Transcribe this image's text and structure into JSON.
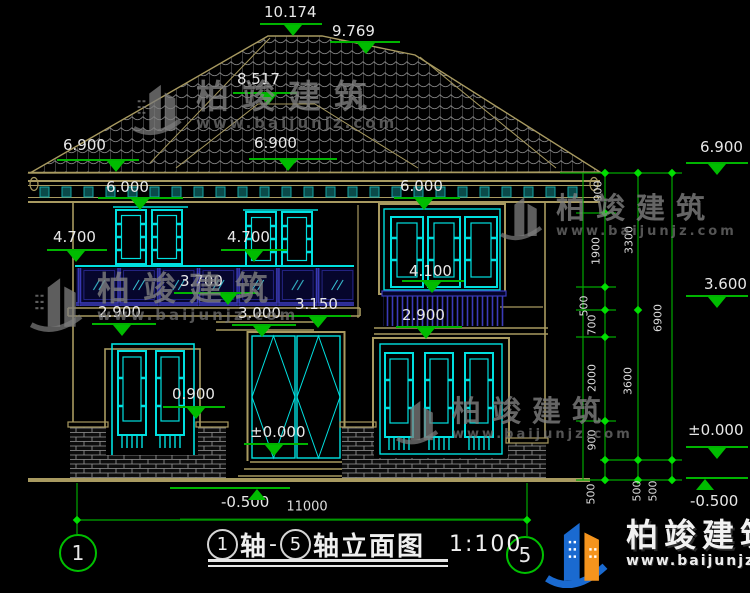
{
  "watermark": {
    "brand": "柏竣建筑",
    "url": "www.baijunjz.com"
  },
  "title_block": {
    "axis_from": "1",
    "zhou": "轴",
    "dash": "-",
    "axis_to": "5",
    "suffix": "轴立面图",
    "scale": "1:100"
  },
  "axis_bubbles": {
    "left": "1",
    "right": "5"
  },
  "colors": {
    "dim_green": "#00b400",
    "cad_cyan": "#00e0e0",
    "cad_tan": "#a89a60",
    "rail_blue": "#3a3ab8",
    "text_white": "#e8e8e8",
    "brand_blue": "#1a6ad0",
    "brand_orange": "#f5941d"
  },
  "elevation_markers": [
    {
      "text": "10.174",
      "tx": 264,
      "ty": 4,
      "lx": 260,
      "lw": 62,
      "ly": 23,
      "ax": 293,
      "dir": "down"
    },
    {
      "text": "9.769",
      "tx": 332,
      "ty": 23,
      "lx": 330,
      "lw": 70,
      "ly": 41,
      "ax": 366,
      "dir": "down"
    },
    {
      "text": "8.517",
      "tx": 237,
      "ty": 71,
      "lx": 233,
      "lw": 64,
      "ly": 92,
      "ax": 268,
      "dir": "down"
    },
    {
      "text": "6.900",
      "tx": 63,
      "ty": 137,
      "lx": 57,
      "lw": 82,
      "ly": 159,
      "ax": 116,
      "dir": "down"
    },
    {
      "text": "6.900",
      "tx": 254,
      "ty": 135,
      "lx": 249,
      "lw": 88,
      "ly": 158,
      "ax": 288,
      "dir": "down"
    },
    {
      "text": "6.900",
      "tx": 700,
      "ty": 139,
      "lx": 686,
      "lw": 62,
      "ly": 162,
      "ax": 717,
      "dir": "down"
    },
    {
      "text": "6.000",
      "tx": 106,
      "ty": 179,
      "lx": 98,
      "lw": 85,
      "ly": 197,
      "ax": 140,
      "dir": "down"
    },
    {
      "text": "6.000",
      "tx": 400,
      "ty": 178,
      "lx": 394,
      "lw": 66,
      "ly": 197,
      "ax": 424,
      "dir": "down"
    },
    {
      "text": "4.700",
      "tx": 53,
      "ty": 229,
      "lx": 47,
      "lw": 60,
      "ly": 249,
      "ax": 76,
      "dir": "down"
    },
    {
      "text": "4.700",
      "tx": 227,
      "ty": 229,
      "lx": 221,
      "lw": 66,
      "ly": 249,
      "ax": 254,
      "dir": "down"
    },
    {
      "text": "3.700",
      "tx": 180,
      "ty": 273,
      "lx": 174,
      "lw": 84,
      "ly": 292,
      "ax": 228,
      "dir": "down"
    },
    {
      "text": "4.100",
      "tx": 409,
      "ty": 263,
      "lx": 402,
      "lw": 62,
      "ly": 280,
      "ax": 432,
      "dir": "down"
    },
    {
      "text": "2.900",
      "tx": 98,
      "ty": 304,
      "lx": 92,
      "lw": 64,
      "ly": 323,
      "ax": 122,
      "dir": "down"
    },
    {
      "text": "3.000",
      "tx": 238,
      "ty": 305,
      "lx": 232,
      "lw": 64,
      "ly": 324,
      "ax": 262,
      "dir": "down"
    },
    {
      "text": "3.150",
      "tx": 295,
      "ty": 296,
      "lx": 289,
      "lw": 62,
      "ly": 315,
      "ax": 318,
      "dir": "down"
    },
    {
      "text": "2.900",
      "tx": 402,
      "ty": 307,
      "lx": 396,
      "lw": 66,
      "ly": 326,
      "ax": 426,
      "dir": "down"
    },
    {
      "text": "3.600",
      "tx": 704,
      "ty": 276,
      "lx": 686,
      "lw": 62,
      "ly": 295,
      "ax": 717,
      "dir": "down"
    },
    {
      "text": "0.900",
      "tx": 172,
      "ty": 386,
      "lx": 163,
      "lw": 62,
      "ly": 406,
      "ax": 196,
      "dir": "down"
    },
    {
      "text": "±0.000",
      "tx": 250,
      "ty": 424,
      "lx": 244,
      "lw": 64,
      "ly": 443,
      "ax": 274,
      "dir": "down"
    },
    {
      "text": "±0.000",
      "tx": 688,
      "ty": 422,
      "lx": 686,
      "lw": 62,
      "ly": 446,
      "ax": 717,
      "dir": "down"
    },
    {
      "text": "-0.500",
      "tx": 221,
      "ty": 494,
      "lx": 170,
      "lw": 120,
      "ly": 487,
      "ax": 257,
      "dir": "up"
    },
    {
      "text": "-0.500",
      "tx": 690,
      "ty": 493,
      "lx": 686,
      "lw": 62,
      "ly": 477,
      "ax": 705,
      "dir": "up"
    }
  ],
  "dim_labels_rotated": [
    {
      "text": "900",
      "x": 598,
      "y": 191
    },
    {
      "text": "1900",
      "x": 596,
      "y": 251
    },
    {
      "text": "500",
      "x": 584,
      "y": 306
    },
    {
      "text": "700",
      "x": 592,
      "y": 325
    },
    {
      "text": "2000",
      "x": 592,
      "y": 378
    },
    {
      "text": "900",
      "x": 592,
      "y": 440
    },
    {
      "text": "500",
      "x": 591,
      "y": 494
    },
    {
      "text": "3300",
      "x": 629,
      "y": 240
    },
    {
      "text": "3600",
      "x": 628,
      "y": 381
    },
    {
      "text": "500",
      "x": 637,
      "y": 491
    },
    {
      "text": "500",
      "x": 653,
      "y": 491
    },
    {
      "text": "6900",
      "x": 658,
      "y": 318
    }
  ],
  "dim_labels_horizontal": [
    {
      "text": "11000",
      "x": 307,
      "y": 507
    }
  ]
}
